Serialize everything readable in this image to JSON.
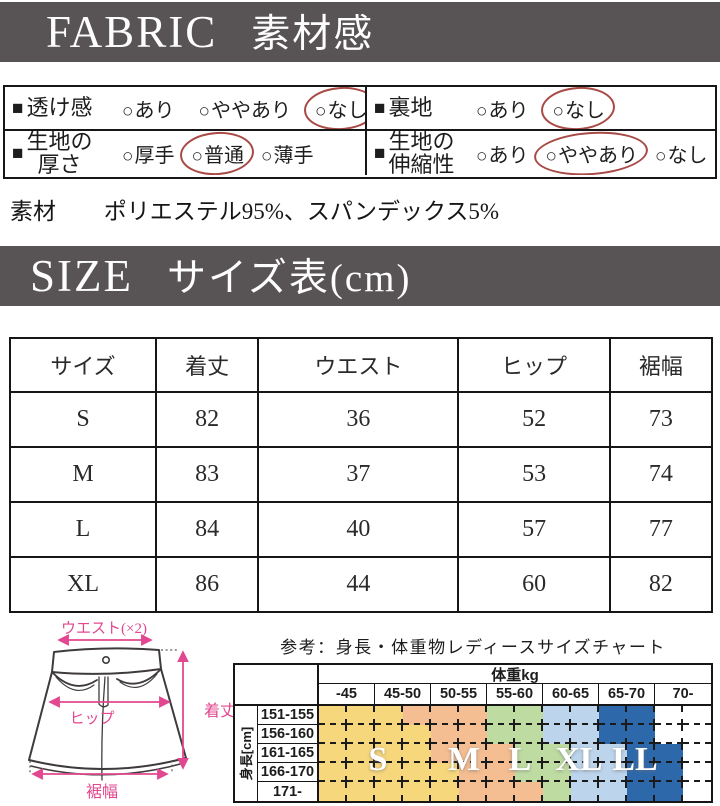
{
  "colors": {
    "header_bar": "#585355",
    "accent_pink": "#e2488f",
    "mark_red": "#a84a45"
  },
  "fabric_header": {
    "en": "FABRIC",
    "ja": "素材感"
  },
  "fabric": {
    "bullet": "■",
    "ring_glyph": "○",
    "rows": [
      {
        "label": "透け感",
        "options": [
          {
            "text": "あり",
            "selected": false
          },
          {
            "text": "ややあり",
            "selected": false
          },
          {
            "text": "なし",
            "selected": true
          }
        ]
      },
      {
        "label": "裏地",
        "options": [
          {
            "text": "あり",
            "selected": false
          },
          {
            "text": "なし",
            "selected": true
          }
        ]
      },
      {
        "label": "生地の\n厚さ",
        "options": [
          {
            "text": "厚手",
            "selected": false
          },
          {
            "text": "普通",
            "selected": true
          },
          {
            "text": "薄手",
            "selected": false
          }
        ]
      },
      {
        "label": "生地の\n伸縮性",
        "options": [
          {
            "text": "あり",
            "selected": false
          },
          {
            "text": "ややあり",
            "selected": true
          },
          {
            "text": "なし",
            "selected": false
          }
        ]
      }
    ]
  },
  "material": {
    "label": "素材",
    "value": "ポリエステル95%、スパンデックス5%"
  },
  "size_header": {
    "en": "SIZE",
    "ja": "サイズ表(cm)"
  },
  "size_table": {
    "columns": [
      "サイズ",
      "着丈",
      "ウエスト",
      "ヒップ",
      "裾幅"
    ],
    "rows": [
      [
        "S",
        "82",
        "36",
        "52",
        "73"
      ],
      [
        "M",
        "83",
        "37",
        "53",
        "74"
      ],
      [
        "L",
        "84",
        "40",
        "57",
        "77"
      ],
      [
        "XL",
        "86",
        "44",
        "60",
        "82"
      ]
    ]
  },
  "diagram": {
    "waist": "ウエスト(×2)",
    "hip": "ヒップ",
    "length": "着丈",
    "hem": "裾幅"
  },
  "ref_chart": {
    "title": "参考：身長・体重物レディースサイズチャート",
    "weight_header": "体重kg",
    "height_header": "身長[cm]",
    "weights": [
      "-45",
      "45-50",
      "50-55",
      "55-60",
      "60-65",
      "65-70",
      "70-"
    ],
    "heights": [
      "151-155",
      "156-160",
      "161-165",
      "166-170",
      "171-"
    ],
    "size_labels": [
      "S",
      "M",
      "L",
      "XL",
      "LL"
    ],
    "palette": {
      "Y": "#f6d77c",
      "O": "#f4bd92",
      "G": "#bedca2",
      "B": "#bdd5ec",
      "D": "#2d68ab",
      "W": "#ffffff"
    },
    "cells": [
      [
        "Y",
        "Y",
        "Y",
        "O",
        "O",
        "O",
        "G",
        "G",
        "B",
        "B",
        "D",
        "D",
        "W",
        "W"
      ],
      [
        "Y",
        "Y",
        "Y",
        "Y",
        "O",
        "O",
        "G",
        "G",
        "B",
        "B",
        "D",
        "D",
        "W",
        "W"
      ],
      [
        "Y",
        "Y",
        "Y",
        "Y",
        "O",
        "O",
        "O",
        "G",
        "G",
        "B",
        "B",
        "D",
        "D",
        "W"
      ],
      [
        "Y",
        "Y",
        "Y",
        "Y",
        "Y",
        "O",
        "O",
        "G",
        "G",
        "B",
        "B",
        "D",
        "D",
        "W"
      ],
      [
        "Y",
        "Y",
        "Y",
        "Y",
        "Y",
        "O",
        "O",
        "O",
        "G",
        "B",
        "B",
        "D",
        "D",
        "W"
      ]
    ]
  }
}
